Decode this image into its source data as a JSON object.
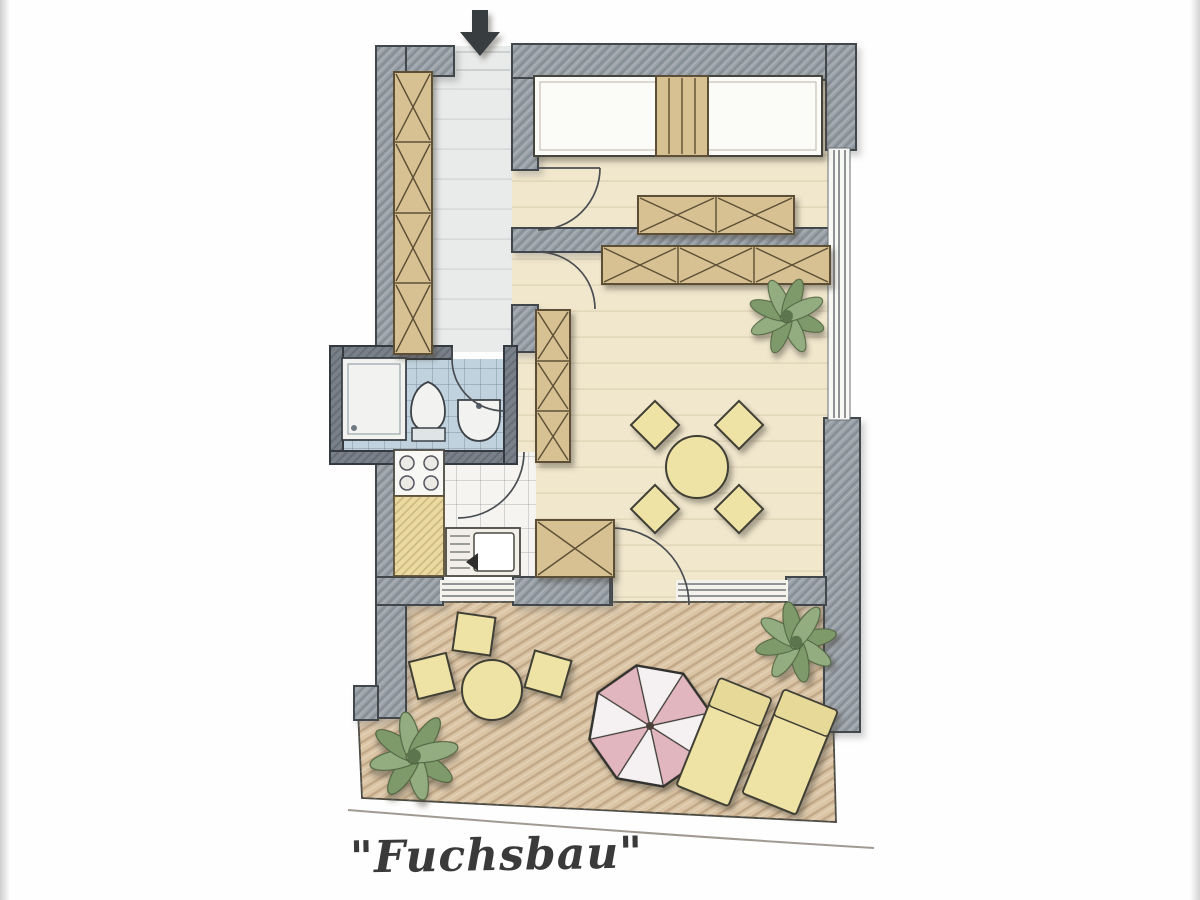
{
  "label": {
    "text": "\"Fuchsbau\""
  },
  "colors": {
    "wall": "#9aa1a8",
    "wallDark": "#788088",
    "wallOutline": "#42474c",
    "floorMain": "#f1e7cd",
    "floorHall": "#e9ebeb",
    "floorKitchen": "#f5f4f0",
    "floorBath": "#bfd2dd",
    "terrace": "#dbc5a5",
    "wood": "#d7c092",
    "woodOutline": "#5c5036",
    "furnitureYellow": "#eee2a4",
    "furnitureOutline": "#3f3f35",
    "parasolPink": "#e2b6be",
    "parasolWhite": "#f5f1f2",
    "plantGreen": "#7e9a6b",
    "plantGreenLight": "#93ad80",
    "arrow": "#383c41",
    "text": "#3a3a3a"
  },
  "plan": {
    "name": "Fuchsbau",
    "entrance": {
      "icon": "entrance-arrow-down"
    },
    "rooms": [
      {
        "name": "hallway",
        "furniture": [
          "wardrobe-4-panels"
        ]
      },
      {
        "name": "bedroom",
        "furniture": [
          "double-bed",
          "headboard",
          "sideboard-2-panels"
        ]
      },
      {
        "name": "living-room",
        "furniture": [
          "sideboard-3-panels",
          "wardrobe-3-panels",
          "cabinet",
          "round-dining-table",
          "chair",
          "chair",
          "chair",
          "chair",
          "plant"
        ]
      },
      {
        "name": "bathroom",
        "furniture": [
          "shower",
          "toilet",
          "washbasin"
        ]
      },
      {
        "name": "kitchen",
        "furniture": [
          "stove-4-burners",
          "counter",
          "kitchen-sink"
        ]
      },
      {
        "name": "terrace",
        "furniture": [
          "round-table",
          "chair",
          "chair",
          "chair",
          "parasol",
          "sun-lounger",
          "sun-lounger",
          "plant",
          "plant"
        ]
      }
    ]
  }
}
